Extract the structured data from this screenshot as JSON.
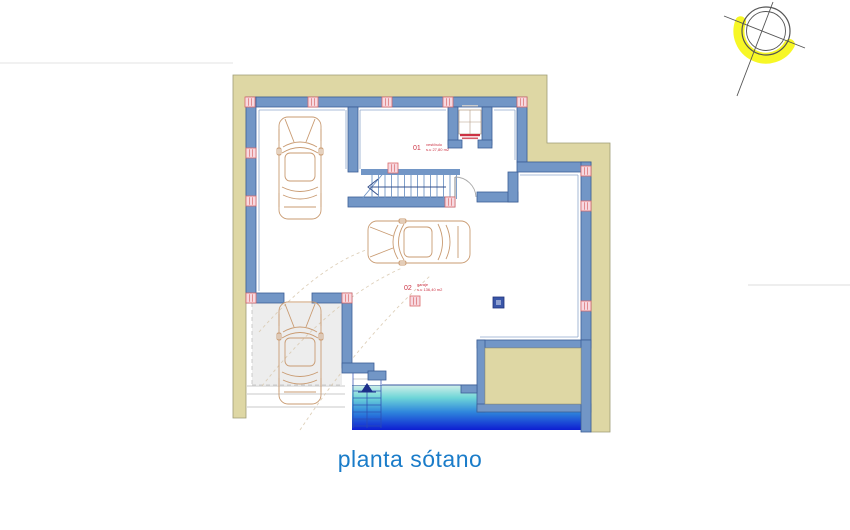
{
  "title": "planta sótano",
  "rooms": [
    {
      "number": "01",
      "name": "vestíbulo",
      "area": "s.u 27,80 m2"
    },
    {
      "number": "02",
      "name": "garaje",
      "area": "s.u 136,40 m2"
    }
  ],
  "icons": {
    "compass": "compass-rose",
    "stairs_up_arrow": "up-arrow",
    "stair_direction_arrow": "left-arrow",
    "elevator": "elevator-cab"
  },
  "colors": {
    "background": "#ffffff",
    "band": "#ded7a4",
    "band_edge": "#9f9c76",
    "wall": "#7296c6",
    "wall_edge": "#3c5e96",
    "wall_inner": "#8fa7cc",
    "marker_fill": "#f7d9e1",
    "marker_edge": "#d96a6a",
    "column_navy": "#3a56a8",
    "column_navy_inner": "#8fa0d0",
    "car": "#c99b72",
    "guide": "#d8c8ae",
    "label_red": "#cc3344",
    "title_blue": "#1a7cc9",
    "ramp_top": "#d2efe9",
    "ramp_mid1": "#6fd6d8",
    "ramp_mid2": "#2f86dc",
    "ramp_bottom": "#0d1ed2",
    "compass_line": "#555555",
    "highlight_yellow": "#f6f600",
    "faint_line": "#e3e3e3",
    "paving_line": "#b8b8b8",
    "bay_fill": "#ededed",
    "stair_detail": "#2c4bb0"
  }
}
